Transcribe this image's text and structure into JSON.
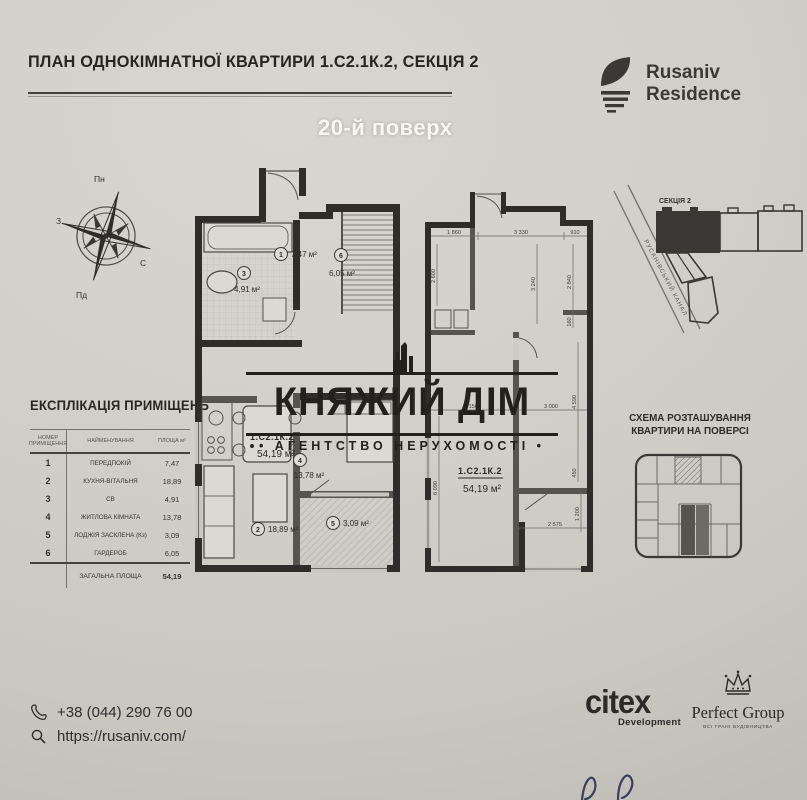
{
  "page": {
    "title": "ПЛАН ОДНОКІМНАТНОЇ КВАРТИРИ 1.С2.1К.2, СЕКЦІЯ 2",
    "floor_label": "20-й поверх"
  },
  "brand_logo": {
    "name_line1": "Rusaniv",
    "name_line2": "Residence"
  },
  "compass": {
    "n": "Пн",
    "s": "Пд",
    "e": "С",
    "w": "З"
  },
  "explication": {
    "title": "ЕКСПЛІКАЦІЯ ПРИМІЩЕНЬ",
    "headers": {
      "number": "НОМЕР ПРИМІЩЕННЯ",
      "name": "НАЙМЕНУВАННЯ",
      "area": "ПЛОЩА м²"
    },
    "rows": [
      {
        "num": "1",
        "name": "ПЕРЕДПОКІЙ",
        "area": "7,47"
      },
      {
        "num": "2",
        "name": "КУХНЯ-ВІТАЛЬНЯ",
        "area": "18,89"
      },
      {
        "num": "3",
        "name": "СВ",
        "area": "4,91"
      },
      {
        "num": "4",
        "name": "ЖИТЛОВА КІМНАТА",
        "area": "13,78"
      },
      {
        "num": "5",
        "name": "ЛОДЖІЯ ЗАСКЛЕНА (Кз)",
        "area": "3,09"
      },
      {
        "num": "6",
        "name": "ГАРДЕРОБ",
        "area": "6,05"
      }
    ],
    "total_label": "ЗАГАЛЬНА ПЛОЩА",
    "total_area": "54,19"
  },
  "furnished_plan": {
    "code": "1.С2.1К.2",
    "area": "54,19 м²",
    "rooms": {
      "r1": {
        "num": "1",
        "area": "7,47 м²"
      },
      "r2": {
        "num": "2",
        "area": "18,89 м²"
      },
      "r3": {
        "num": "3",
        "area": "4,91 м²"
      },
      "r4": {
        "num": "4",
        "area": "13,78 м²"
      },
      "r5": {
        "num": "5",
        "area": "3,09 м²"
      },
      "r6": {
        "num": "6",
        "area": "6,05 м²"
      }
    }
  },
  "dimension_plan": {
    "code": "1.С2.1К.2",
    "area": "54,19 м²",
    "dims": {
      "top_left": "1 860",
      "top_mid": "3 330",
      "top_right": "910",
      "left_upper": "2 600",
      "mid_vert": "3 240",
      "right_upper": "2 840",
      "right_step": "160",
      "right_mid": "4 590",
      "right_lower": "450",
      "right_bottom": "1 200",
      "mid_left": "3 150",
      "mid_right": "3 000",
      "left_lower": "6 090",
      "bottom": "2 575"
    }
  },
  "site_plan": {
    "section": "СЕКЦІЯ 2",
    "canal": "РУСАНІВСЬКИЙ КАНАЛ"
  },
  "floor_scheme": {
    "title1": "СХЕМА РОЗТАШУВАННЯ",
    "title2": "КВАРТИРИ НА ПОВЕРСІ"
  },
  "watermark": {
    "brand": "КНЯЖИЙ ДІМ",
    "tagline": "• АГЕНТСТВО НЕРУХОМОСТІ •"
  },
  "contacts": {
    "phone": "+38 (044) 290 76 00",
    "website": "https://rusaniv.com/"
  },
  "developers": {
    "citex": "citex",
    "citex_sub": "Development",
    "pg": "Perfect Group",
    "pg_sub": "ВСІ ГРАНІ БУДІВНИЦТВА"
  },
  "colors": {
    "ink": "#2c2a27",
    "paper": "#d2cfca",
    "wall": "#2f2d2a"
  }
}
